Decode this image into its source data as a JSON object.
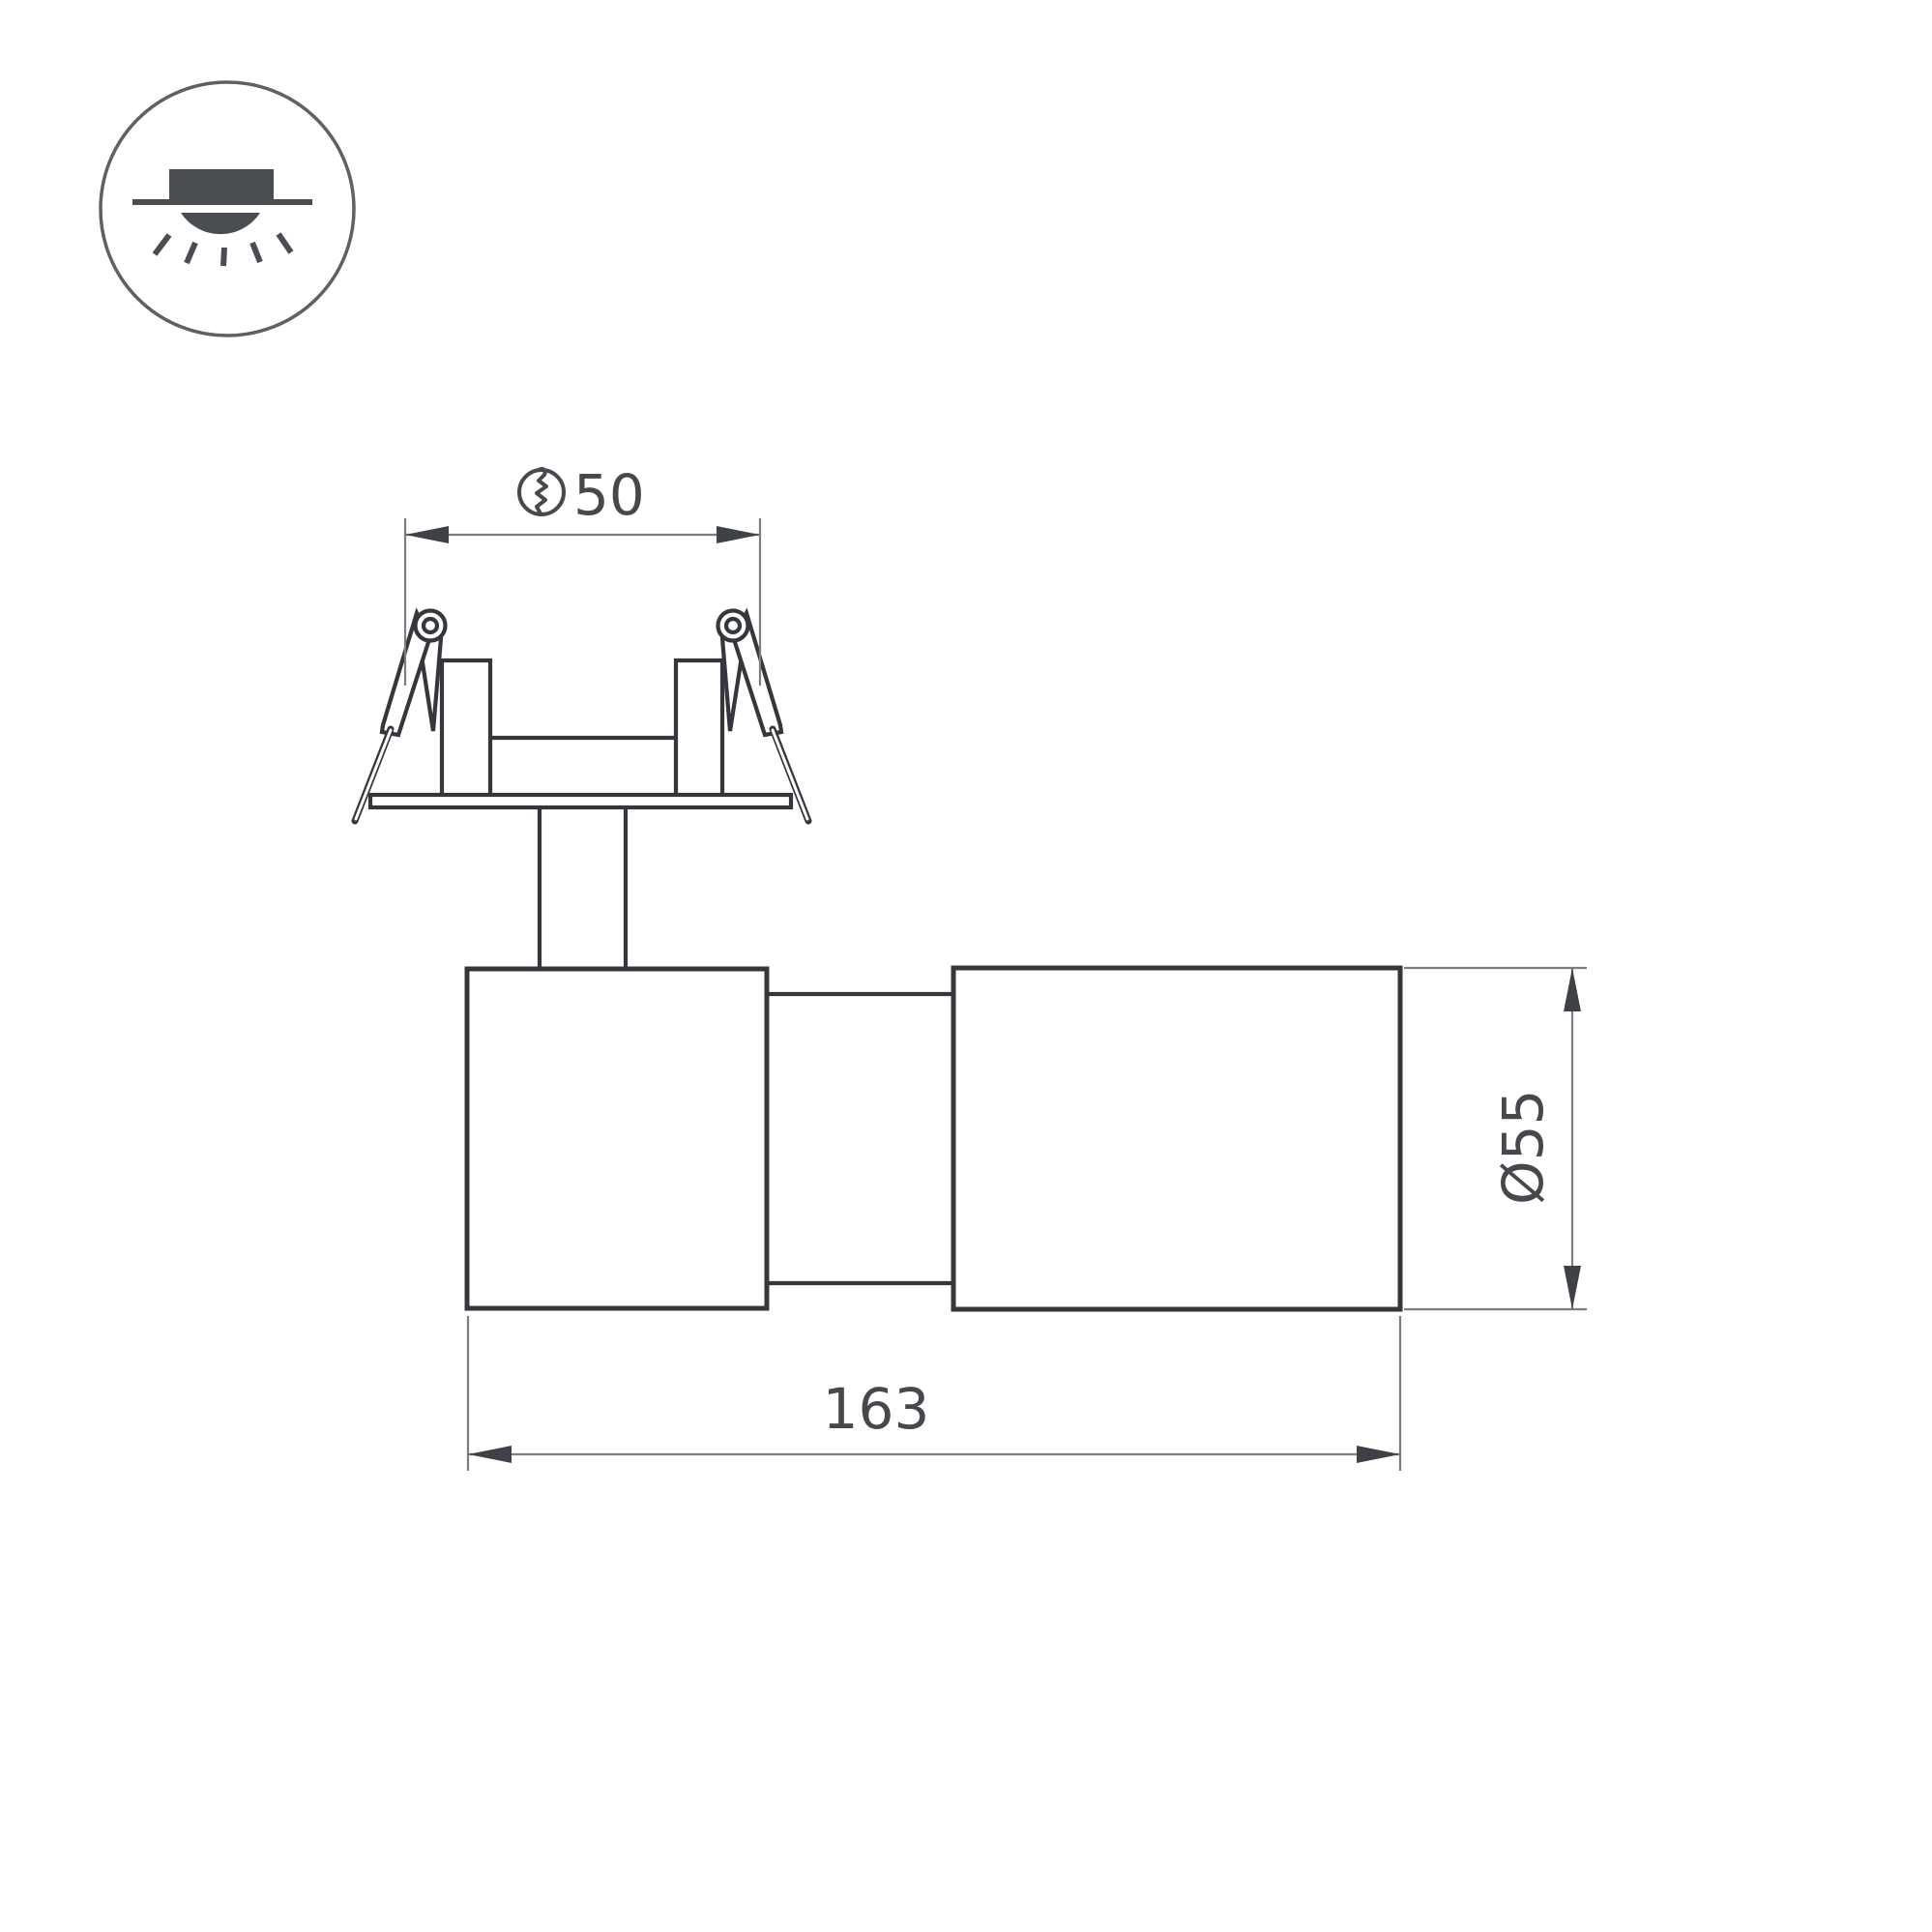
{
  "page": {
    "background": "#ffffff"
  },
  "icon": {
    "name": "recessed-downlight"
  },
  "drawing": {
    "dimensions": {
      "cutout": {
        "value": "50",
        "symbol": "hole-cutout-circle"
      },
      "length": {
        "value": "163"
      },
      "diameter": {
        "value": "Ø55"
      }
    },
    "colors": {
      "outline": "#34383c",
      "dimension_line": "#7b7e81",
      "arrow": "#3e4246",
      "text": "#45484c",
      "icon": "#4a4e53"
    }
  }
}
